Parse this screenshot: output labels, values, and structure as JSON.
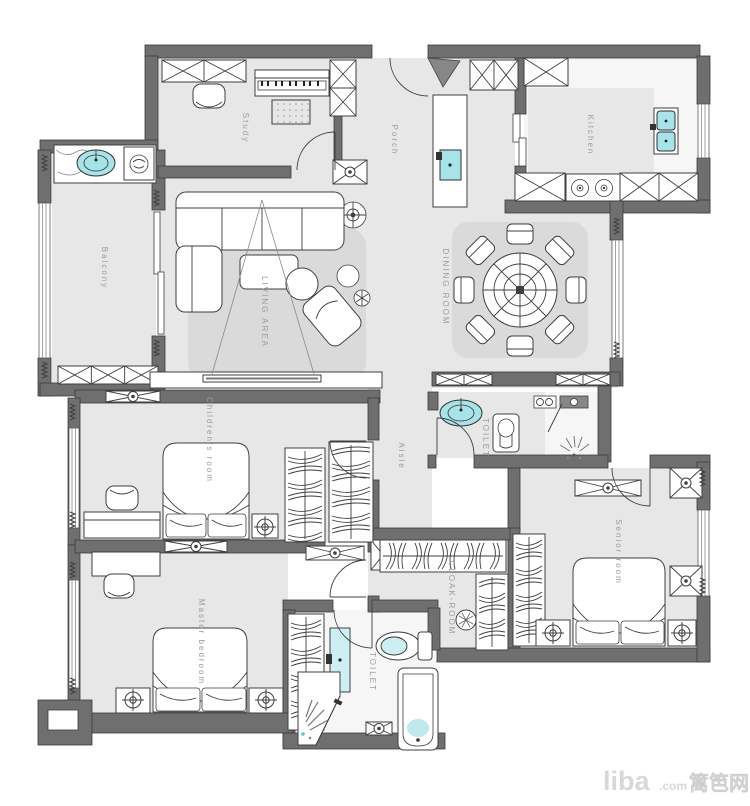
{
  "window": {
    "width": 750,
    "height": 806
  },
  "colors": {
    "wall": "#6f6f6f",
    "floor": "#e7e7e7",
    "rug": "#dadada",
    "outline": "#3f3f3f",
    "fixture_teal": "#a8e3ea",
    "label": "#9c9c9c",
    "watermark": "#d8d8d8"
  },
  "rooms": {
    "study": {
      "label": "Study"
    },
    "porch": {
      "label": "Porch"
    },
    "kitchen": {
      "label": "Kitchen"
    },
    "balcony": {
      "label": "Balcony"
    },
    "living_area": {
      "label": "LIVING AREA"
    },
    "dining_room": {
      "label": "DINING ROOM"
    },
    "aisle": {
      "label": "Aisle"
    },
    "toilet_middle": {
      "label": "TOILET"
    },
    "childrens_room": {
      "label": "Children's room"
    },
    "cloak_room": {
      "label": "CLOAK-ROOM"
    },
    "senior_room": {
      "label": "Senior room"
    },
    "master_bedroom": {
      "label": "Master bedroom"
    },
    "toilet_bottom": {
      "label": "TOILET"
    }
  },
  "watermark": {
    "brand": "liba",
    "suffix": ".com",
    "cjk": "篱笆网"
  }
}
